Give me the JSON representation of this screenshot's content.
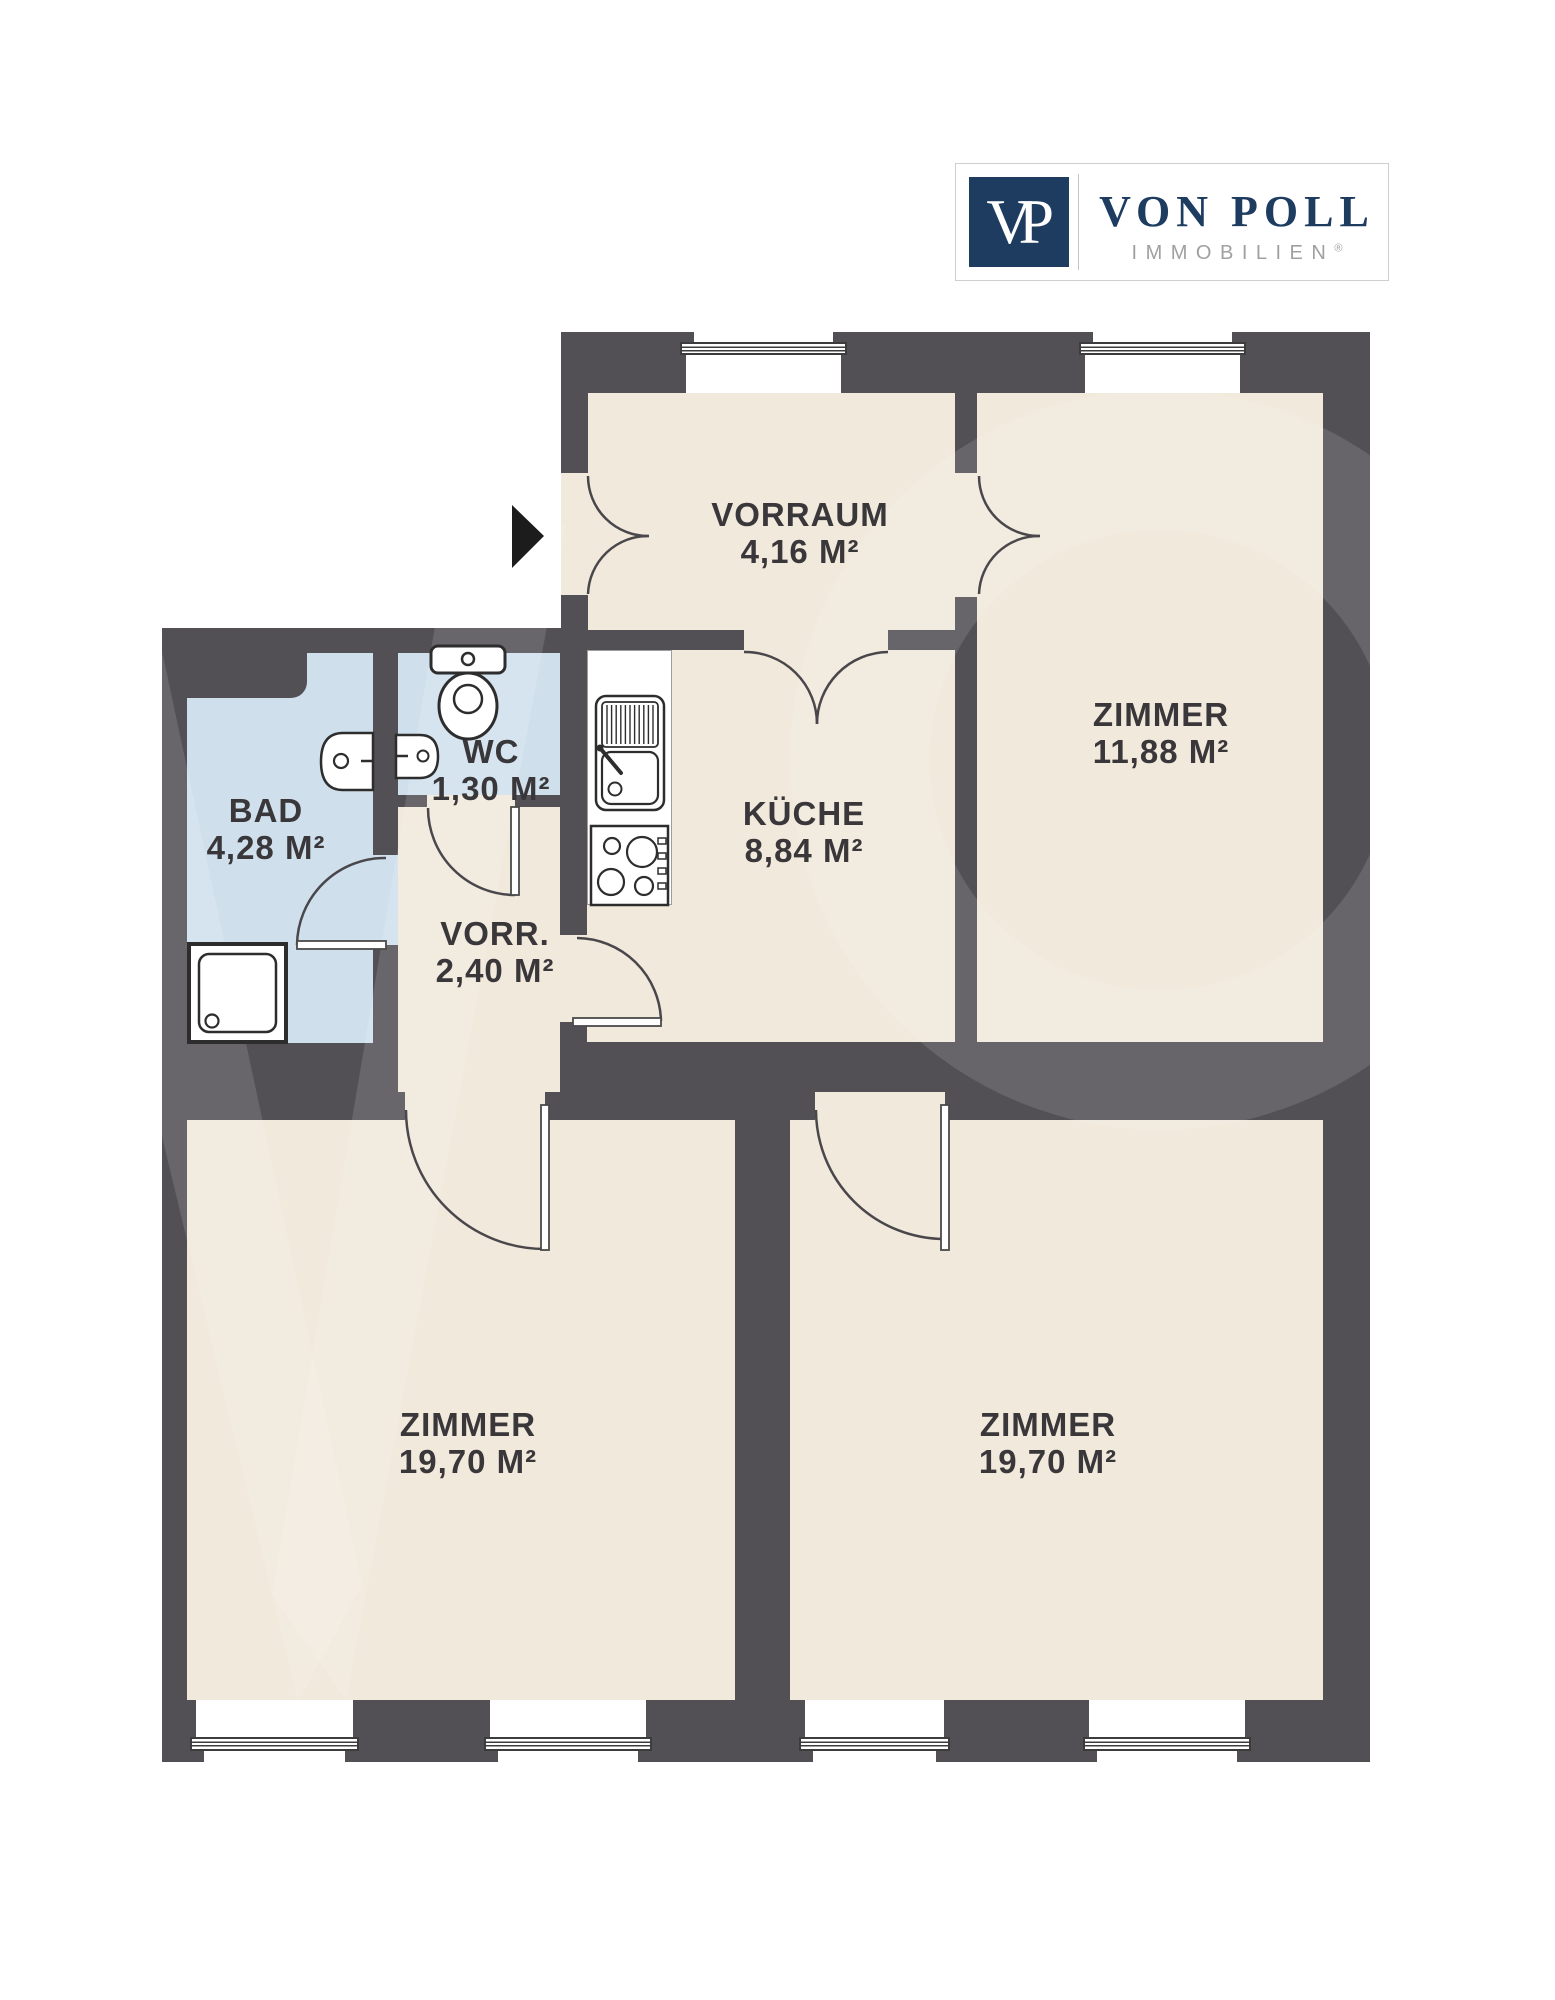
{
  "logo": {
    "monogram": "VP",
    "brand": "VON POLL",
    "subtitle": "IMMOBILIEN",
    "registered": "®"
  },
  "rooms": {
    "vorraum": {
      "name": "VORRAUM",
      "area": "4,16 M²"
    },
    "zimmer_top": {
      "name": "ZIMMER",
      "area": "11,88 M²"
    },
    "wc": {
      "name": "WC",
      "area": "1,30 M²"
    },
    "bad": {
      "name": "BAD",
      "area": "4,28 M²"
    },
    "vorr": {
      "name": "VORR.",
      "area": "2,40 M²"
    },
    "kueche": {
      "name": "KÜCHE",
      "area": "8,84 M²"
    },
    "zimmer_left": {
      "name": "ZIMMER",
      "area": "19,70 M²"
    },
    "zimmer_right": {
      "name": "ZIMMER",
      "area": "19,70 M²"
    }
  },
  "colors": {
    "wall": "#525055",
    "floor": "#f1e9db",
    "wet_floor": "#cfe0ec",
    "label_text": "#3a373b",
    "logo_navy": "#1d3c60",
    "logo_gray": "#a0a0a0",
    "fixture_outline": "#2d2d2d"
  },
  "icons": {
    "entrance": "entrance-arrow-icon",
    "wc_fixtures": [
      "toilet-icon",
      "hand-basin-icon"
    ],
    "bad_fixtures": [
      "wash-basin-icon",
      "shower-icon"
    ],
    "kueche_fixtures": [
      "kitchen-sink-icon",
      "stove-icon"
    ]
  }
}
